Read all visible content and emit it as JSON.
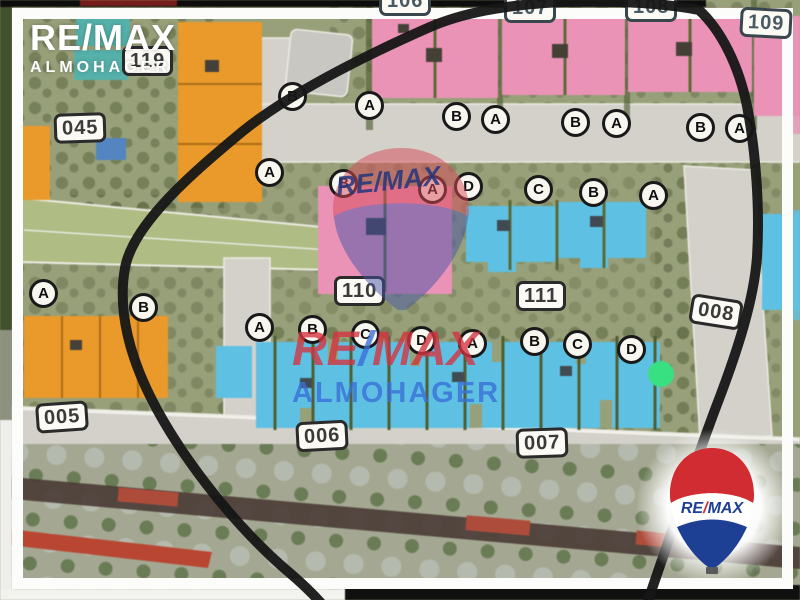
{
  "branding": {
    "corner_logo": {
      "line1": "RE/MAX",
      "line2": "ALMOHAGER"
    },
    "center_watermark": {
      "line1_pre": "RE",
      "line1_slash": "/",
      "line1_post": "MAX",
      "line2": "ALMOHAGER"
    },
    "balloon_watermark_text": "RE/MAX",
    "balloon_logo": {
      "text_pre": "RE",
      "slash": "/",
      "text_post": "MAX",
      "registered": "®"
    }
  },
  "map": {
    "plot_badges": [
      {
        "value": "045",
        "x": 54,
        "y": 113,
        "rot": -2,
        "tone": "dark"
      },
      {
        "value": "119",
        "x": 122,
        "y": 46,
        "rot": 0,
        "tone": "dark"
      },
      {
        "value": "106",
        "x": 379,
        "y": -14,
        "rot": 0,
        "tone": "teal"
      },
      {
        "value": "107",
        "x": 504,
        "y": -7,
        "rot": 0,
        "tone": "teal"
      },
      {
        "value": "108",
        "x": 625,
        "y": -8,
        "rot": 0,
        "tone": "teal"
      },
      {
        "value": "109",
        "x": 740,
        "y": 8,
        "rot": 3,
        "tone": "teal"
      },
      {
        "value": "110",
        "x": 334,
        "y": 276,
        "rot": 0,
        "tone": "dark"
      },
      {
        "value": "111",
        "x": 516,
        "y": 281,
        "rot": 0,
        "tone": "dark"
      },
      {
        "value": "005",
        "x": 36,
        "y": 402,
        "rot": -4,
        "tone": "dark"
      },
      {
        "value": "006",
        "x": 296,
        "y": 421,
        "rot": -3,
        "tone": "dark"
      },
      {
        "value": "007",
        "x": 516,
        "y": 428,
        "rot": -2,
        "tone": "dark"
      },
      {
        "value": "008",
        "x": 690,
        "y": 297,
        "rot": 9,
        "tone": "dark"
      }
    ],
    "unit_letters": [
      {
        "label": "B",
        "cx": 293,
        "cy": 97
      },
      {
        "label": "A",
        "cx": 370,
        "cy": 106
      },
      {
        "label": "B",
        "cx": 457,
        "cy": 117
      },
      {
        "label": "A",
        "cx": 496,
        "cy": 120
      },
      {
        "label": "B",
        "cx": 576,
        "cy": 123
      },
      {
        "label": "A",
        "cx": 617,
        "cy": 124
      },
      {
        "label": "B",
        "cx": 701,
        "cy": 128
      },
      {
        "label": "A",
        "cx": 740,
        "cy": 129
      },
      {
        "label": "A",
        "cx": 270,
        "cy": 173
      },
      {
        "label": "B",
        "cx": 344,
        "cy": 184
      },
      {
        "label": "A",
        "cx": 433,
        "cy": 190
      },
      {
        "label": "D",
        "cx": 469,
        "cy": 187
      },
      {
        "label": "C",
        "cx": 539,
        "cy": 190
      },
      {
        "label": "B",
        "cx": 594,
        "cy": 193
      },
      {
        "label": "A",
        "cx": 654,
        "cy": 196
      },
      {
        "label": "A",
        "cx": 44,
        "cy": 294
      },
      {
        "label": "B",
        "cx": 144,
        "cy": 308
      },
      {
        "label": "A",
        "cx": 260,
        "cy": 328
      },
      {
        "label": "B",
        "cx": 313,
        "cy": 330
      },
      {
        "label": "C",
        "cx": 366,
        "cy": 335
      },
      {
        "label": "D",
        "cx": 422,
        "cy": 341
      },
      {
        "label": "A",
        "cx": 473,
        "cy": 344
      },
      {
        "label": "B",
        "cx": 535,
        "cy": 342
      },
      {
        "label": "C",
        "cx": 578,
        "cy": 345
      },
      {
        "label": "D",
        "cx": 632,
        "cy": 350
      }
    ],
    "marker": {
      "shape": "dot",
      "color": "#2ee47e",
      "cx": 661,
      "cy": 374
    },
    "annotation_loop_color": "#161616"
  },
  "palette": {
    "base": "#98a077",
    "trees": "#4c592f",
    "park": "#aebd7f",
    "road": "#d3d1c9",
    "pink": "#f191b8",
    "cyan": "#57c3e9",
    "orange": "#f0991f",
    "pool": "#4fb3ab",
    "poolblue": "#4f86c6",
    "maroon": "#4a3a33",
    "redband": "#b54a38",
    "frame_white": "#fcfcfa",
    "wm_red": "#d5333f",
    "wm_blue": "#3a6fd8",
    "logo_red": "#d12c32",
    "logo_blue": "#1d3f94",
    "dot_green": "#2ee47e"
  }
}
